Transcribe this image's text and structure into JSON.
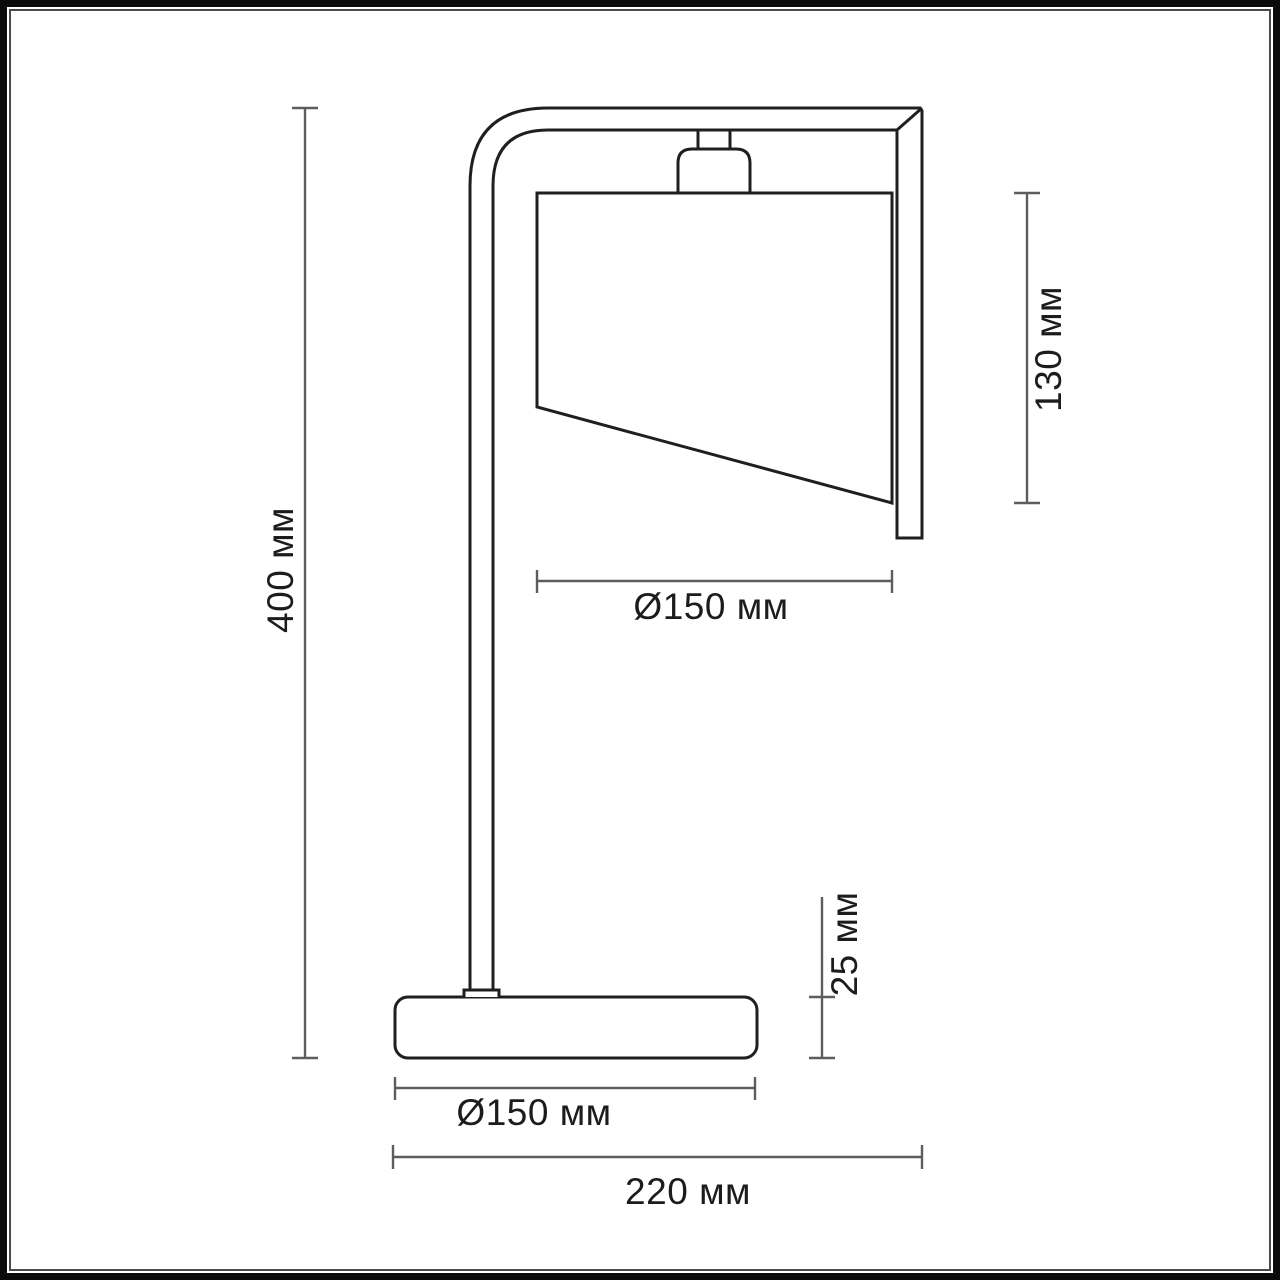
{
  "colors": {
    "ink": "#1c1c1c",
    "outline": "#1f1f1f",
    "dimension": "#5d5d5d",
    "background": "#ffffff",
    "frame": "#0a0a0a",
    "frame_inner": "#4a4a4a"
  },
  "drawing": {
    "units": "мм",
    "labels": {
      "overall_height": "400 мм",
      "shade_height": "130 мм",
      "shade_diameter": "Ø150 мм",
      "base_height": "25 мм",
      "base_diameter": "Ø150 мм",
      "overall_depth": "220 мм"
    },
    "values": {
      "overall_height_mm": 400,
      "shade_height_mm": 130,
      "shade_diameter_mm": 150,
      "base_height_mm": 25,
      "base_diameter_mm": 150,
      "overall_depth_mm": 220
    }
  }
}
